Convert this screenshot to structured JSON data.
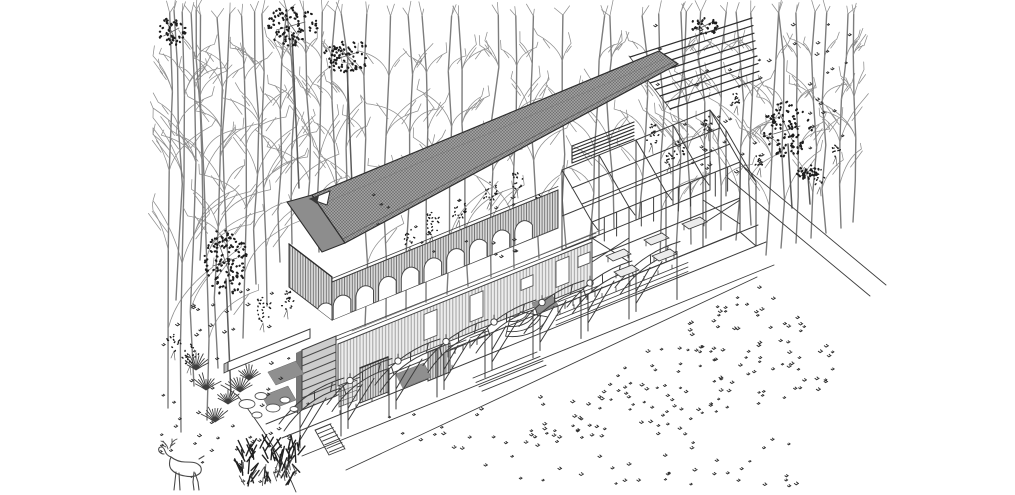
{
  "illustration": {
    "kind": "exploded axonometric architectural drawing",
    "subject": "long pavilion in a forest clearing with meadow and deer",
    "visible_text": "",
    "palette": {
      "background": "#ffffff",
      "ink": "#3d3d3d",
      "ink_dark": "#2e2e2e",
      "tree_stroke": "#7d7d7d",
      "twig_stroke": "#8f8f8f",
      "foliage_dark": "#1d1d1d",
      "roof_fill": "#9e9e9e",
      "roof_hatch": "#6a6a6a",
      "roof_fold": "#8d8d8d",
      "screen_fill": "#d9d9d9",
      "screen_stripe": "#6f6f6f",
      "wall_fill": "#ededed",
      "wall_stripe": "#9a9a9a",
      "mat_fill": "#8f8f8f",
      "louver_fill": "#cccccc",
      "sprig": "#303030"
    },
    "layers": [
      {
        "id": "forest-background",
        "label": "bare winter trees and dark canopies"
      },
      {
        "id": "roof-canopy-layer",
        "label": "floating hatched roof plane with exposed purlins and fascia louvers"
      },
      {
        "id": "arched-screen-layer",
        "label": "suspended arched screen wall with vertical slats"
      },
      {
        "id": "pavilion-floor-layer",
        "label": "floor plate with awning bays, doors, planters and stairs"
      },
      {
        "id": "steel-frame-layer",
        "label": "exposed structural frame bays"
      },
      {
        "id": "grounds-layer",
        "label": "terrace edges, paths and meadow planting"
      },
      {
        "id": "wildlife-layer",
        "label": "deer, shrubs, rocks and grasses"
      }
    ],
    "counts": {
      "roof_purlins": 9,
      "fascia_louvers": 6,
      "screen_arches": 9,
      "awning_bays": 8,
      "frame_bays": 5,
      "straight_stair_steps": 7,
      "fan_stair_treads": 5,
      "walkway_benches": 4,
      "frame_tables": 5
    }
  },
  "scene": {
    "trees_bare": [
      [
        168,
        408,
        395
      ],
      [
        181,
        432,
        420
      ],
      [
        194,
        386,
        372
      ],
      [
        207,
        420,
        405
      ],
      [
        218,
        368,
        350
      ],
      [
        231,
        310,
        296
      ],
      [
        243,
        338,
        322
      ],
      [
        256,
        284,
        272
      ],
      [
        267,
        306,
        292
      ],
      [
        280,
        262,
        252
      ],
      [
        292,
        244,
        232
      ],
      [
        306,
        224,
        212
      ],
      [
        319,
        252,
        240
      ],
      [
        333,
        234,
        222
      ],
      [
        347,
        238,
        224
      ],
      [
        176,
        300,
        290
      ],
      [
        200,
        260,
        250
      ],
      [
        365,
        326,
        312
      ],
      [
        386,
        318,
        302
      ],
      [
        406,
        310,
        294
      ],
      [
        426,
        302,
        286
      ],
      [
        447,
        294,
        278
      ],
      [
        468,
        286,
        270
      ],
      [
        491,
        277,
        262
      ],
      [
        514,
        268,
        252
      ],
      [
        539,
        258,
        242
      ],
      [
        566,
        247,
        232
      ],
      [
        590,
        238,
        222
      ],
      [
        614,
        228,
        212
      ],
      [
        639,
        218,
        202
      ],
      [
        660,
        260,
        246
      ],
      [
        676,
        252,
        240
      ],
      [
        691,
        244,
        232
      ],
      [
        706,
        238,
        226
      ],
      [
        721,
        230,
        218
      ],
      [
        736,
        240,
        228
      ],
      [
        751,
        225,
        212
      ],
      [
        766,
        255,
        242
      ],
      [
        781,
        248,
        236
      ],
      [
        796,
        243,
        230
      ],
      [
        811,
        238,
        226
      ],
      [
        826,
        233,
        220
      ],
      [
        841,
        228,
        214
      ],
      [
        853,
        222,
        208
      ]
    ],
    "trees_foliage": [
      {
        "x": 292,
        "y": 26,
        "rx": 26,
        "ry": 20,
        "n": 85,
        "trunk": [
          299,
          188
        ]
      },
      {
        "x": 347,
        "y": 56,
        "rx": 23,
        "ry": 18,
        "n": 70,
        "trunk": [
          352,
          186
        ]
      },
      {
        "x": 172,
        "y": 32,
        "rx": 14,
        "ry": 16,
        "n": 45,
        "trunk": null
      },
      {
        "x": 226,
        "y": 262,
        "rx": 22,
        "ry": 34,
        "n": 110,
        "trunk": [
          231,
          396
        ]
      },
      {
        "x": 788,
        "y": 130,
        "rx": 24,
        "ry": 28,
        "n": 90,
        "trunk": [
          792,
          208
        ]
      },
      {
        "x": 808,
        "y": 172,
        "rx": 12,
        "ry": 9,
        "n": 30,
        "trunk": [
          810,
          204
        ]
      },
      {
        "x": 705,
        "y": 26,
        "rx": 15,
        "ry": 9,
        "n": 28,
        "trunk": null
      }
    ],
    "shrubs": [
      [
        432,
        224,
        8,
        12,
        22
      ],
      [
        459,
        210,
        7,
        10,
        18
      ],
      [
        490,
        192,
        7,
        10,
        18
      ],
      [
        517,
        180,
        6,
        9,
        15
      ],
      [
        263,
        310,
        9,
        13,
        22
      ],
      [
        287,
        300,
        7,
        10,
        16
      ],
      [
        190,
        354,
        9,
        12,
        20
      ],
      [
        174,
        342,
        7,
        9,
        14
      ],
      [
        652,
        134,
        7,
        11,
        16
      ],
      [
        680,
        150,
        6,
        9,
        13
      ],
      [
        708,
        124,
        5,
        8,
        12
      ],
      [
        737,
        98,
        5,
        8,
        11
      ],
      [
        820,
        178,
        6,
        9,
        12
      ],
      [
        836,
        150,
        5,
        7,
        10
      ],
      [
        670,
        158,
        5,
        7,
        10
      ],
      [
        760,
        160,
        5,
        8,
        11
      ],
      [
        410,
        238,
        6,
        9,
        12
      ],
      [
        540,
        200,
        5,
        8,
        10
      ]
    ],
    "sprig_fields": [
      {
        "shape": "tri",
        "pts": [
          [
            757,
            278
          ],
          [
            864,
            382
          ],
          [
            472,
            470
          ]
        ],
        "n": 150,
        "seed": 91
      },
      {
        "shape": "rect",
        "r": [
          500,
          428,
          300,
          60
        ],
        "n": 42,
        "seed": 92
      },
      {
        "shape": "rect",
        "r": [
          645,
          20,
          205,
          148
        ],
        "n": 46,
        "seed": 93
      },
      {
        "shape": "rect",
        "r": [
          160,
          288,
          150,
          170
        ],
        "n": 40,
        "seed": 94
      },
      {
        "shape": "rect",
        "r": [
          158,
          418,
          135,
          68
        ],
        "n": 18,
        "seed": 95
      },
      {
        "shape": "rect",
        "r": [
          362,
          188,
          185,
          80
        ],
        "n": 20,
        "seed": 96
      },
      {
        "shape": "rect",
        "r": [
          388,
          398,
          165,
          55
        ],
        "n": 15,
        "seed": 97
      },
      {
        "shape": "rect",
        "r": [
          690,
          120,
          80,
          60
        ],
        "n": 10,
        "seed": 98
      }
    ],
    "rocks": [
      [
        247,
        404,
        8,
        4.5
      ],
      [
        261,
        396,
        6,
        3.5
      ],
      [
        273,
        408,
        7,
        4
      ],
      [
        285,
        400,
        5,
        3
      ],
      [
        257,
        415,
        5,
        3
      ],
      [
        294,
        409,
        4,
        2.5
      ]
    ],
    "spiky_plants": [
      [
        206,
        390
      ],
      [
        228,
        404
      ],
      [
        249,
        380
      ],
      [
        215,
        422
      ],
      [
        196,
        370
      ],
      [
        240,
        392
      ]
    ],
    "bush": {
      "x": 270,
      "y": 466
    },
    "deer": {
      "x": 158,
      "y": 436
    }
  }
}
